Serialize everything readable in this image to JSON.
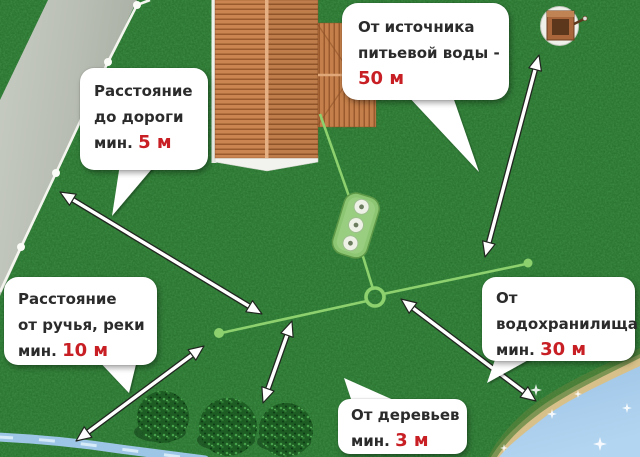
{
  "title": "Схема размещения септика на участке",
  "callouts": {
    "road": {
      "line1": "Расстояние",
      "line2": "до дороги",
      "line3_prefix": "мин. ",
      "value": "5 м"
    },
    "drinking_water": {
      "line1": "От источника",
      "line2": "питьевой воды -",
      "line3_prefix": "",
      "value": "50 м"
    },
    "stream": {
      "line1": "Расстояние",
      "line2": "от ручья, реки",
      "line3_prefix": "мин. ",
      "value": "10 м"
    },
    "reservoir": {
      "line1": "От",
      "line2": "водохранилища",
      "line3_prefix": "мин. ",
      "value": "30 м"
    },
    "trees": {
      "line1": "От деревьев",
      "line2_prefix": "мин. ",
      "value": "3 м"
    }
  },
  "scene": {
    "elements": [
      "road",
      "boundary-fence-line",
      "house-roof",
      "drinking-water-well",
      "septic-tank",
      "sewer-pipe",
      "drain-field-lines",
      "junction-ring",
      "bushes",
      "stream",
      "reservoir-water",
      "beach",
      "water-sparkles",
      "distance-arrows"
    ]
  },
  "colors": {
    "accent_red": "#c81f25",
    "text": "#2b2b2b",
    "bubble_bg": "#ffffff",
    "grass_green": "#2a7d31",
    "road_gray": "#b9beb4",
    "roof_orange": "#c9854f",
    "pipe_green": "#8dd06e",
    "water_blue": "#a6cbe9",
    "sand": "#d7c089"
  }
}
